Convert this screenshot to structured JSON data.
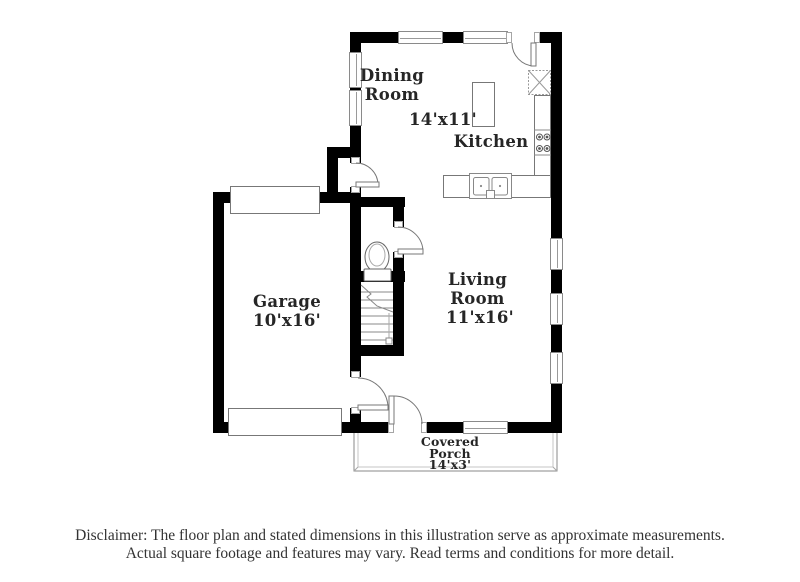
{
  "plan": {
    "labels": {
      "dining": "Dining Room",
      "dining_kitchen_dims": "14'x11'",
      "kitchen": "Kitchen",
      "garage": "Garage",
      "garage_dims": "10'x16'",
      "living": "Living Room",
      "living_dims": "11'x16'",
      "porch": "Covered Porch",
      "porch_dims": "14'x3'"
    },
    "fixtures": [
      "staircase",
      "toilet",
      "refrigerator",
      "stove-burners",
      "double-sink",
      "kitchen-island",
      "garage-door",
      "window",
      "door-swing",
      "covered-porch-outline"
    ],
    "colors": {
      "wall": "#000000",
      "fixture_line": "#666666",
      "background": "#ffffff",
      "label_text": "#262626"
    }
  },
  "disclaimer": {
    "line1": "Disclaimer: The floor plan and stated dimensions in this illustration serve as approximate measurements.",
    "line2": "Actual square footage and features may vary. Read terms and conditions for more detail."
  }
}
